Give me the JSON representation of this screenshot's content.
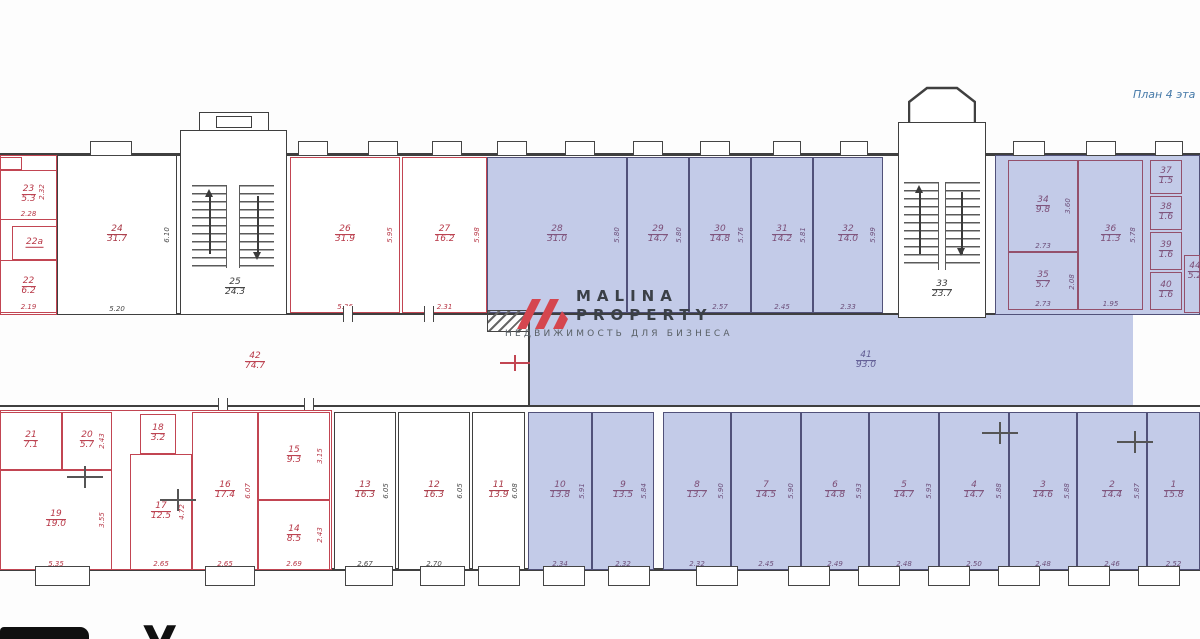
{
  "header": {
    "plan_label": "План 4 эта"
  },
  "watermark": {
    "line1": "MALINA",
    "line2": "PROPERTY",
    "tagline": "НЕДВИЖИМОСТЬ ДЛЯ БИЗНЕСА"
  },
  "footer": {
    "partial_heading": "У"
  },
  "colors": {
    "highlight_fill": "#c3cbe8",
    "red_wall": "#c24552",
    "dark_wall": "#3f3f3f",
    "blue_wall": "#515179",
    "watermark_red": "#d5464f",
    "plan_label_blue": "#4579a8"
  },
  "stairwells": {
    "s25": {
      "n": "25",
      "a": "24.3"
    },
    "s33": {
      "n": "33",
      "a": "23.7"
    }
  },
  "corridors": {
    "c41": {
      "n": "41",
      "a": "93.0"
    },
    "c42": {
      "n": "42",
      "a": "74.7"
    }
  },
  "dims": {
    "d232": "2.32",
    "d208": "2.08"
  },
  "rooms": {
    "r1": {
      "n": "1",
      "a": "15.8",
      "wd": "2.52"
    },
    "r2": {
      "n": "2",
      "a": "14.4",
      "wd": "2.46",
      "hd": "5.87"
    },
    "r3": {
      "n": "3",
      "a": "14.6",
      "wd": "2.48",
      "hd": "5.88"
    },
    "r4": {
      "n": "4",
      "a": "14.7",
      "wd": "2.50",
      "hd": "5.88"
    },
    "r5": {
      "n": "5",
      "a": "14.7",
      "wd": "2.48",
      "hd": "5.93"
    },
    "r6": {
      "n": "6",
      "a": "14.8",
      "wd": "2.49",
      "hd": "5.93"
    },
    "r7": {
      "n": "7",
      "a": "14.5",
      "wd": "2.45",
      "hd": "5.90"
    },
    "r8": {
      "n": "8",
      "a": "13.7",
      "wd": "2.32",
      "hd": "5.90"
    },
    "r9": {
      "n": "9",
      "a": "13.5",
      "wd": "2.32",
      "hd": "5.84"
    },
    "r10": {
      "n": "10",
      "a": "13.8",
      "wd": "2.34",
      "hd": "5.91"
    },
    "r11": {
      "n": "11",
      "a": "13.9",
      "hd": "6.08"
    },
    "r12": {
      "n": "12",
      "a": "16.3",
      "wd": "2.70",
      "hd": "6.05"
    },
    "r13": {
      "n": "13",
      "a": "16.3",
      "wd": "2.67",
      "hd": "6.05"
    },
    "r14": {
      "n": "14",
      "a": "8.5",
      "wd": "2.69",
      "hd": "2.43"
    },
    "r15": {
      "n": "15",
      "a": "9.3",
      "hd": "3.15"
    },
    "r16": {
      "n": "16",
      "a": "17.4",
      "wd": "2.65",
      "hd": "6.07"
    },
    "r17": {
      "n": "17",
      "a": "12.5",
      "wd": "2.65",
      "hd": "4.72"
    },
    "r18": {
      "n": "18",
      "a": "3.2"
    },
    "r19": {
      "n": "19",
      "a": "19.0",
      "wd": "5.35",
      "hd": "3.55"
    },
    "r20": {
      "n": "20",
      "a": "5.7",
      "hd": "2.43"
    },
    "r21": {
      "n": "21",
      "a": "7.1"
    },
    "r22": {
      "n": "22",
      "a": "6.2",
      "wd": "2.19"
    },
    "r22a": {
      "n": "22а"
    },
    "r23": {
      "n": "23",
      "a": "5.3",
      "wd": "2.28"
    },
    "r24": {
      "n": "24",
      "a": "31.7",
      "wd": "5.20",
      "hd": "6.10"
    },
    "r26": {
      "n": "26",
      "a": "31.9",
      "wd": "5.36",
      "hd": "5.95"
    },
    "r27": {
      "n": "27",
      "a": "16.2",
      "wd": "2.31",
      "hd": "5.98"
    },
    "r28": {
      "n": "28",
      "a": "31.0",
      "hd": "5.80"
    },
    "r29": {
      "n": "29",
      "a": "14.7",
      "hd": "5.80"
    },
    "r30": {
      "n": "30",
      "a": "14.8",
      "wd": "2.57",
      "hd": "5.76"
    },
    "r31": {
      "n": "31",
      "a": "14.2",
      "wd": "2.45",
      "hd": "5.81"
    },
    "r32": {
      "n": "32",
      "a": "14.0",
      "wd": "2.33",
      "hd": "5.99"
    },
    "r34": {
      "n": "34",
      "a": "9.8",
      "wd": "2.73",
      "hd": "3.60"
    },
    "r35": {
      "n": "35",
      "a": "5.7",
      "wd": "2.73"
    },
    "r36": {
      "n": "36",
      "a": "11.3",
      "wd": "1.95",
      "hd": "5.78"
    },
    "r37": {
      "n": "37",
      "a": "1.5"
    },
    "r38": {
      "n": "38",
      "a": "1.6"
    },
    "r39": {
      "n": "39",
      "a": "1.6"
    },
    "r40": {
      "n": "40",
      "a": "1.6"
    },
    "r44": {
      "n": "44",
      "a": "5.2"
    }
  }
}
